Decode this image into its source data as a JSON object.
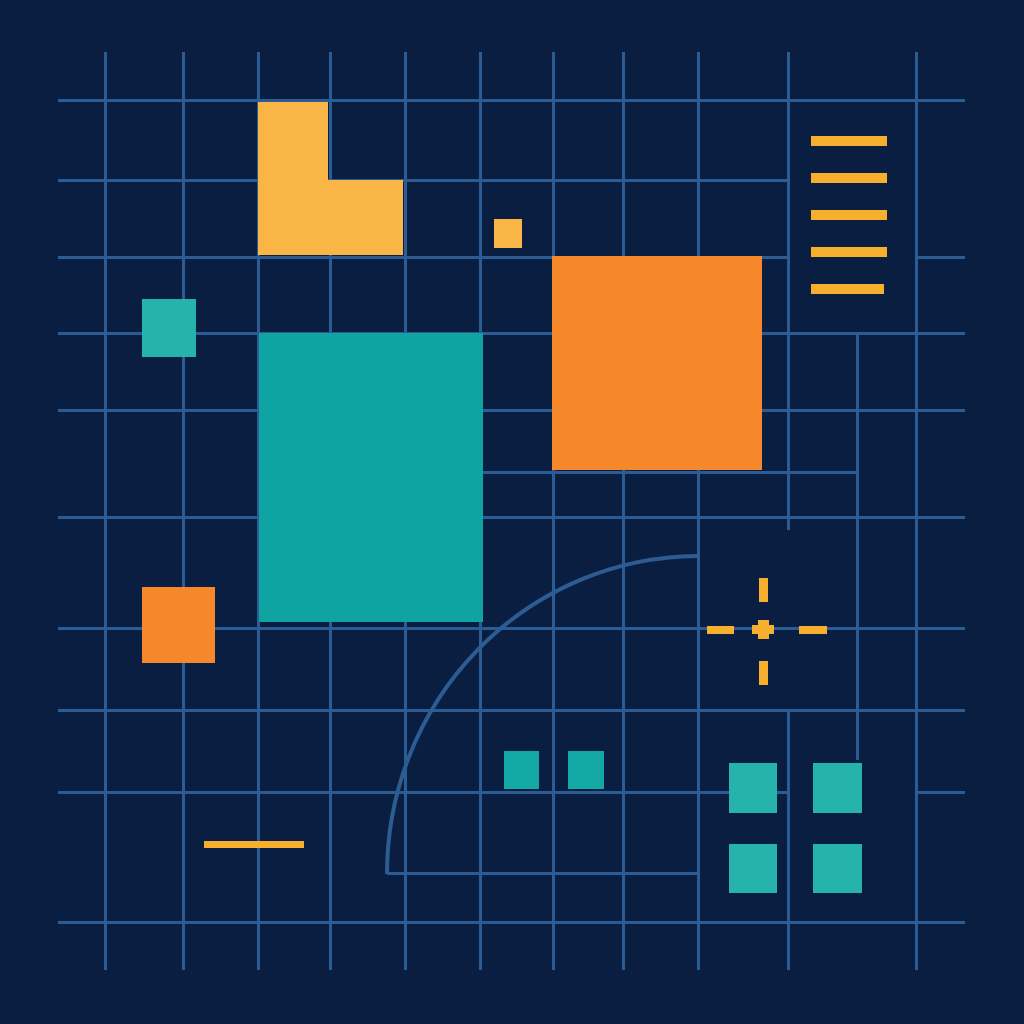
{
  "canvas": {
    "width": 1024,
    "height": 1024,
    "background": "#0A1E42"
  },
  "colors": {
    "grid": "#2C5C94",
    "amber": "#F9B646",
    "amber_line": "#F7B02E",
    "orange": "#F6882B",
    "teal": "#0FA3A1",
    "teal_bright": "#26B3AB",
    "teal_mid": "#14A8A4"
  },
  "grid": {
    "thickness": 3,
    "vertical_lines": [
      {
        "x": 105,
        "y1": 52,
        "y2": 970
      },
      {
        "x": 183,
        "y1": 52,
        "y2": 970
      },
      {
        "x": 258,
        "y1": 52,
        "y2": 970
      },
      {
        "x": 330,
        "y1": 52,
        "y2": 970
      },
      {
        "x": 405,
        "y1": 52,
        "y2": 970
      },
      {
        "x": 480,
        "y1": 52,
        "y2": 970
      },
      {
        "x": 553,
        "y1": 52,
        "y2": 970
      },
      {
        "x": 623,
        "y1": 52,
        "y2": 970
      },
      {
        "x": 698,
        "y1": 52,
        "y2": 970
      },
      {
        "x": 788,
        "y1": 52,
        "y2": 530
      },
      {
        "x": 788,
        "y1": 710,
        "y2": 970
      },
      {
        "x": 857,
        "y1": 333,
        "y2": 760
      },
      {
        "x": 916,
        "y1": 52,
        "y2": 970
      }
    ],
    "horizontal_lines": [
      {
        "y": 100,
        "x1": 58,
        "x2": 965
      },
      {
        "y": 180,
        "x1": 58,
        "x2": 788
      },
      {
        "y": 257,
        "x1": 58,
        "x2": 788
      },
      {
        "y": 257,
        "x1": 915,
        "x2": 965
      },
      {
        "y": 333,
        "x1": 58,
        "x2": 965
      },
      {
        "y": 410,
        "x1": 58,
        "x2": 965
      },
      {
        "y": 472,
        "x1": 483,
        "x2": 857
      },
      {
        "y": 517,
        "x1": 58,
        "x2": 965
      },
      {
        "y": 628,
        "x1": 58,
        "x2": 965
      },
      {
        "y": 710,
        "x1": 58,
        "x2": 965
      },
      {
        "y": 792,
        "x1": 58,
        "x2": 788
      },
      {
        "y": 792,
        "x1": 916,
        "x2": 965
      },
      {
        "y": 873,
        "x1": 387,
        "x2": 700
      },
      {
        "y": 922,
        "x1": 58,
        "x2": 965
      }
    ]
  },
  "shapes": {
    "l_shape": {
      "name": "amber-l-shape",
      "x": 258,
      "y": 102,
      "w": 145,
      "h": 153,
      "color": "amber",
      "points": [
        [
          0,
          0
        ],
        [
          70,
          0
        ],
        [
          70,
          78
        ],
        [
          145,
          78
        ],
        [
          145,
          153
        ],
        [
          0,
          153
        ]
      ]
    },
    "squares": [
      {
        "name": "amber-small-square",
        "x": 494,
        "y": 219,
        "w": 28,
        "h": 29,
        "color": "amber"
      },
      {
        "name": "orange-large-square",
        "x": 552,
        "y": 256,
        "w": 210,
        "h": 214,
        "color": "orange"
      },
      {
        "name": "teal-large-rect",
        "x": 259,
        "y": 333,
        "w": 224,
        "h": 289,
        "color": "teal"
      },
      {
        "name": "teal-small-square-left",
        "x": 142,
        "y": 299,
        "w": 54,
        "h": 58,
        "color": "teal_bright"
      },
      {
        "name": "orange-small-square-left",
        "x": 142,
        "y": 587,
        "w": 73,
        "h": 76,
        "color": "orange"
      },
      {
        "name": "teal-mini-square-1",
        "x": 504,
        "y": 751,
        "w": 35,
        "h": 38,
        "color": "teal_mid"
      },
      {
        "name": "teal-mini-square-2",
        "x": 568,
        "y": 751,
        "w": 36,
        "h": 38,
        "color": "teal_mid"
      },
      {
        "name": "teal-grid-square-tl",
        "x": 729,
        "y": 763,
        "w": 48,
        "h": 50,
        "color": "teal_bright"
      },
      {
        "name": "teal-grid-square-tr",
        "x": 813,
        "y": 763,
        "w": 49,
        "h": 50,
        "color": "teal_bright"
      },
      {
        "name": "teal-grid-square-bl",
        "x": 729,
        "y": 844,
        "w": 48,
        "h": 49,
        "color": "teal_bright"
      },
      {
        "name": "teal-grid-square-br",
        "x": 813,
        "y": 844,
        "w": 49,
        "h": 49,
        "color": "teal_bright"
      }
    ],
    "bars": [
      {
        "name": "amber-bar-1",
        "x": 811,
        "y": 136,
        "w": 76,
        "h": 10,
        "color": "amber_line"
      },
      {
        "name": "amber-bar-2",
        "x": 811,
        "y": 173,
        "w": 76,
        "h": 10,
        "color": "amber_line"
      },
      {
        "name": "amber-bar-3",
        "x": 811,
        "y": 210,
        "w": 76,
        "h": 10,
        "color": "amber_line"
      },
      {
        "name": "amber-bar-4",
        "x": 811,
        "y": 247,
        "w": 76,
        "h": 10,
        "color": "amber_line"
      },
      {
        "name": "amber-bar-5",
        "x": 811,
        "y": 284,
        "w": 73,
        "h": 10,
        "color": "amber_line"
      },
      {
        "name": "amber-dash-bottom-left",
        "x": 204,
        "y": 841,
        "w": 100,
        "h": 7,
        "color": "amber_line"
      }
    ],
    "crosshair": {
      "parts": [
        {
          "name": "crosshair-top-tick",
          "x": 759,
          "y": 578,
          "w": 9,
          "h": 24,
          "color": "amber_line"
        },
        {
          "name": "crosshair-bottom-tick",
          "x": 759,
          "y": 661,
          "w": 9,
          "h": 24,
          "color": "amber_line"
        },
        {
          "name": "crosshair-left-tick",
          "x": 707,
          "y": 626,
          "w": 27,
          "h": 8,
          "color": "amber_line"
        },
        {
          "name": "crosshair-right-tick",
          "x": 799,
          "y": 626,
          "w": 28,
          "h": 8,
          "color": "amber_line"
        },
        {
          "name": "crosshair-center-v",
          "x": 758,
          "y": 620,
          "w": 11,
          "h": 19,
          "color": "amber_line"
        },
        {
          "name": "crosshair-center-h",
          "x": 752,
          "y": 625,
          "w": 22,
          "h": 9,
          "color": "amber_line"
        }
      ]
    },
    "arc": {
      "path": "M 387 874 A 312 318 0 0 1 698 556",
      "stroke_width": 4
    }
  }
}
